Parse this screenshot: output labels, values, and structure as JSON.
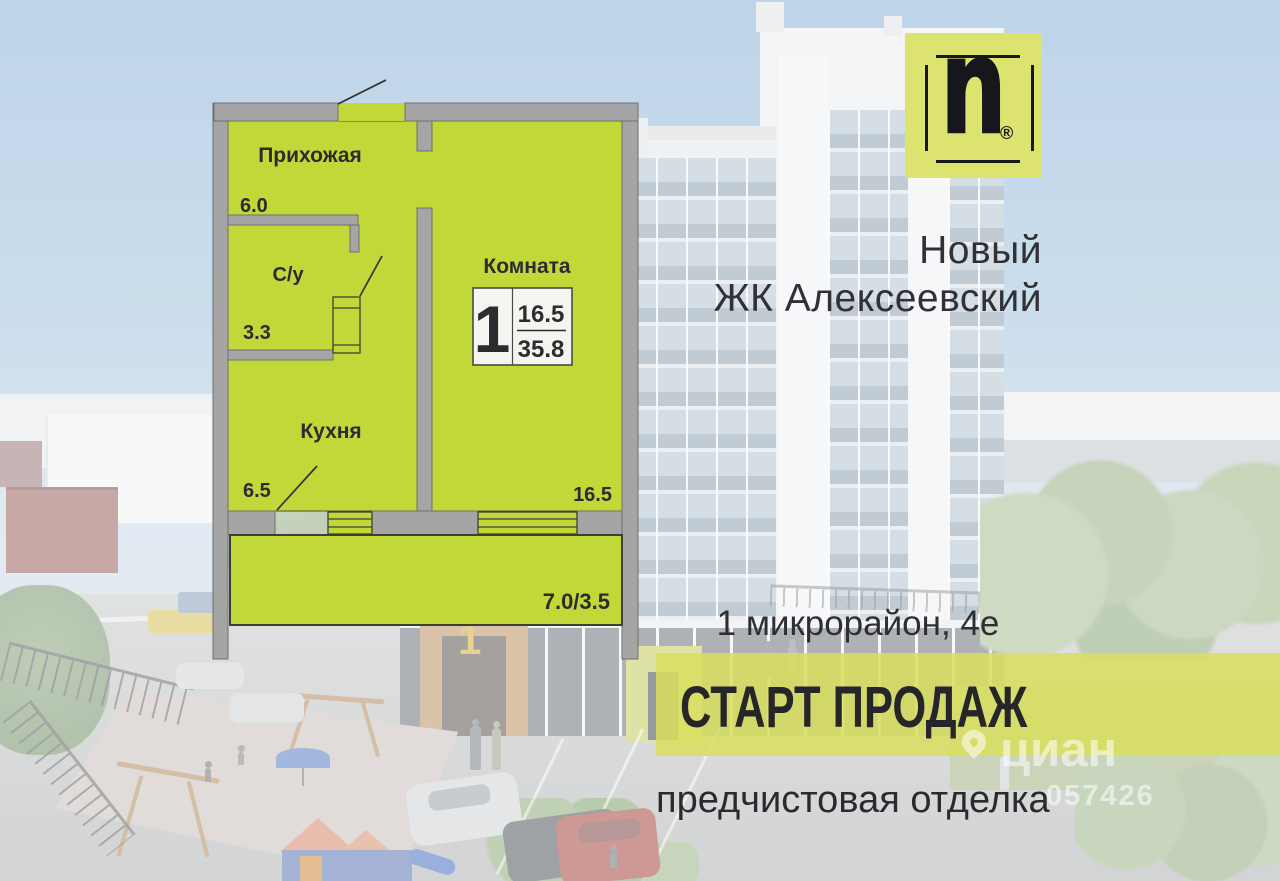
{
  "header": {
    "logo": {
      "letter": "n",
      "registered": "®"
    },
    "title_line1": "Новый",
    "title_line2": "ЖК Алексеевский"
  },
  "floorplan": {
    "rooms": [
      {
        "name": "Прихожая",
        "area": "6.0"
      },
      {
        "name": "С/у",
        "area": "3.3"
      },
      {
        "name": "Кухня",
        "area": "6.5"
      },
      {
        "name": "Комната",
        "area": "16.5"
      }
    ],
    "badge": {
      "rooms": "1",
      "living_area": "16.5",
      "total_area": "35.8"
    },
    "balcony_area": "7.0/3.5"
  },
  "location": "1 микрорайон, 4е",
  "banner": "СТАРТ ПРОДАЖ",
  "finish": "предчистовая отделка",
  "watermark": {
    "brand": "циан",
    "number": "057426"
  },
  "scene": {
    "building_sign": "1"
  },
  "colors": {
    "plan_lime": "#c1d838",
    "wall_gray": "#a5a5a5",
    "banner_lime": "#d9de5d",
    "logo_lime": "#dce46f",
    "text_dark": "#2e2e32"
  }
}
